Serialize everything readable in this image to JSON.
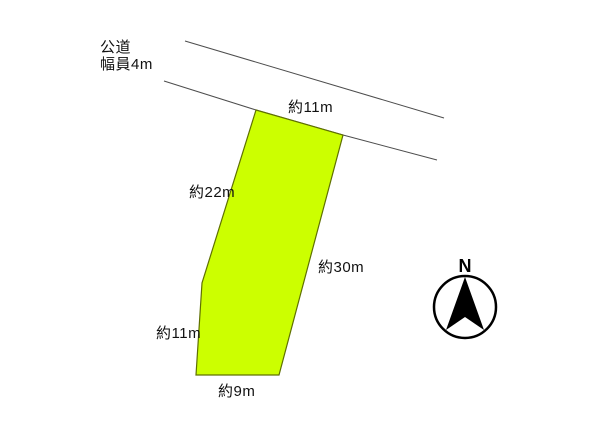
{
  "diagram": {
    "type": "land-plot-site-plan",
    "background": "#ffffff"
  },
  "road": {
    "name": "公道",
    "width_label": "幅員4m",
    "line_color": "#4d4d4d"
  },
  "parcel": {
    "fill": "#ccff00",
    "stroke": "#5f7000",
    "dimensions": [
      {
        "side": "top",
        "label": "約11m"
      },
      {
        "side": "upper-left",
        "label": "約22m"
      },
      {
        "side": "right",
        "label": "約30m"
      },
      {
        "side": "lower-left",
        "label": "約11m"
      },
      {
        "side": "bottom",
        "label": "約9m"
      }
    ]
  },
  "compass": {
    "label": "N",
    "color": "#000000"
  }
}
